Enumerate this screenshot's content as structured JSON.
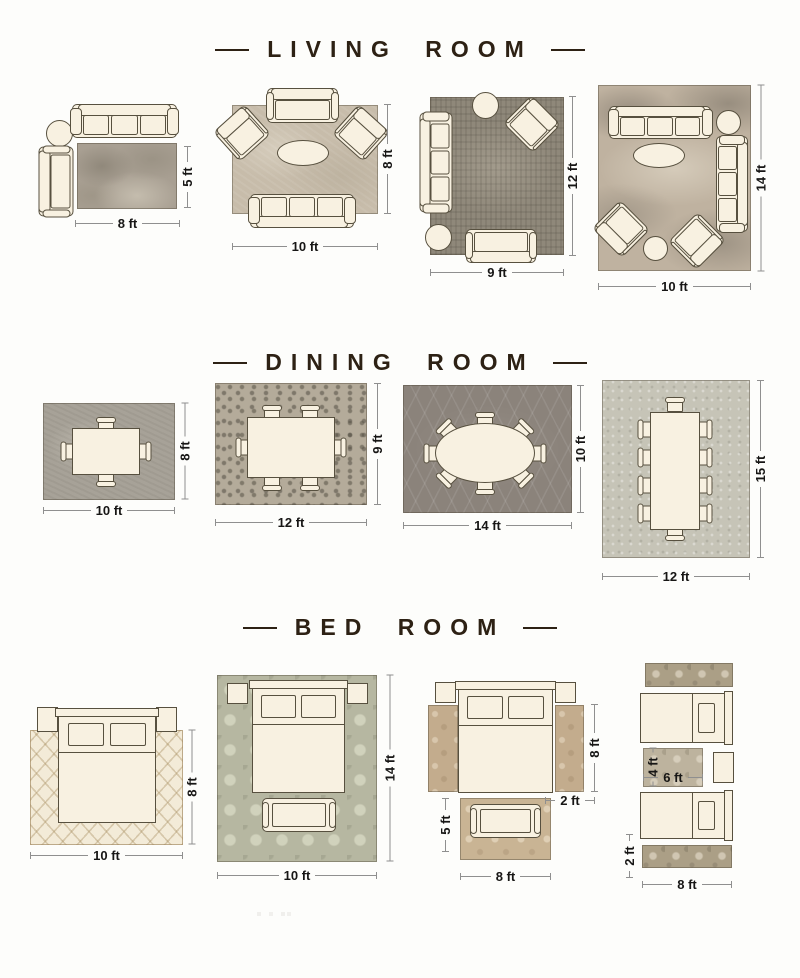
{
  "colors": {
    "background": "#fdfdfb",
    "furniture_fill": "#f8f1e1",
    "furniture_outline": "#57503f",
    "header_text": "#2d2114",
    "dim_text": "#171615",
    "dim_line": "#8f8f8f",
    "rug_living_1": "#a89f92",
    "rug_living_2": "#c7bcaa",
    "rug_living_3": "#8f887a",
    "rug_living_4": "#bfb2a0",
    "rug_dining_1": "#a7a298",
    "rug_dining_2": "#b4ab9a",
    "rug_dining_3": "#8b837b",
    "rug_dining_4": "#c6c4b7",
    "rug_bed_1": "#f3ebd8",
    "rug_bed_2": "#b6b7a1",
    "rug_bed_3_runner": "#c3ac8d",
    "rug_bed_3_foot": "#c9b494",
    "rug_bed_4_runner": "#ab9f86",
    "rug_bed_4_center": "#bdb39e"
  },
  "sections": [
    {
      "title": "LIVING ROOM",
      "layouts": [
        {
          "rug_size": "8 ft x 5 ft",
          "width_ft": "8 ft",
          "height_ft": "5 ft",
          "furniture": [
            "3-seat sofa",
            "round side table",
            "chaise sofa"
          ]
        },
        {
          "rug_size": "10 ft x 8 ft",
          "width_ft": "10 ft",
          "height_ft": "8 ft",
          "furniture": [
            "loveseat",
            "2 armchairs",
            "oval coffee table",
            "3-seat sofa"
          ]
        },
        {
          "rug_size": "9 ft x 12 ft",
          "width_ft": "9 ft",
          "height_ft": "12 ft",
          "furniture": [
            "3-seat sofa",
            "armchair",
            "2 round side tables",
            "loveseat"
          ]
        },
        {
          "rug_size": "10 ft x 14 ft",
          "width_ft": "10 ft",
          "height_ft": "14 ft",
          "furniture": [
            "2 sofas",
            "2 armchairs",
            "oval coffee table",
            "2 round side tables"
          ]
        }
      ]
    },
    {
      "title": "DINING ROOM",
      "layouts": [
        {
          "rug_size": "10 ft x 8 ft",
          "width_ft": "10 ft",
          "height_ft": "8 ft",
          "furniture": [
            "rectangular dining table",
            "4 chairs"
          ]
        },
        {
          "rug_size": "12 ft x 9 ft",
          "width_ft": "12 ft",
          "height_ft": "9 ft",
          "furniture": [
            "rectangular dining table",
            "6 chairs"
          ]
        },
        {
          "rug_size": "14 ft x 10 ft",
          "width_ft": "14 ft",
          "height_ft": "10 ft",
          "furniture": [
            "oval dining table",
            "8 chairs"
          ]
        },
        {
          "rug_size": "12 ft x 15 ft",
          "width_ft": "12 ft",
          "height_ft": "15 ft",
          "furniture": [
            "long dining table",
            "10 chairs"
          ]
        }
      ]
    },
    {
      "title": "BED ROOM",
      "layouts": [
        {
          "rug_size": "10 ft x 8 ft",
          "width_ft": "10 ft",
          "height_ft": "8 ft",
          "furniture": [
            "queen bed",
            "2 nightstands"
          ]
        },
        {
          "rug_size": "10 ft x 14 ft",
          "width_ft": "10 ft",
          "height_ft": "14 ft",
          "furniture": [
            "queen bed",
            "2 nightstands",
            "bench"
          ]
        },
        {
          "rug_size": "8 ft x 5 ft",
          "width_ft": "8 ft",
          "height_ft": "5 ft",
          "runner_height_ft": "8 ft",
          "runner_width_ft": "2 ft",
          "furniture": [
            "queen bed",
            "2 nightstands",
            "2 side runners",
            "foot-of-bed rug",
            "bench"
          ]
        },
        {
          "rug_size": "8 ft x 2 ft runners, 6 ft x 4 ft center rug",
          "width_ft": "8 ft",
          "runner_width_ft": "2 ft",
          "center_rug_width_ft": "6 ft",
          "center_rug_height_ft": "4 ft",
          "furniture": [
            "2 twin beds",
            "nightstand",
            "2 runners",
            "center rug"
          ]
        }
      ]
    }
  ]
}
